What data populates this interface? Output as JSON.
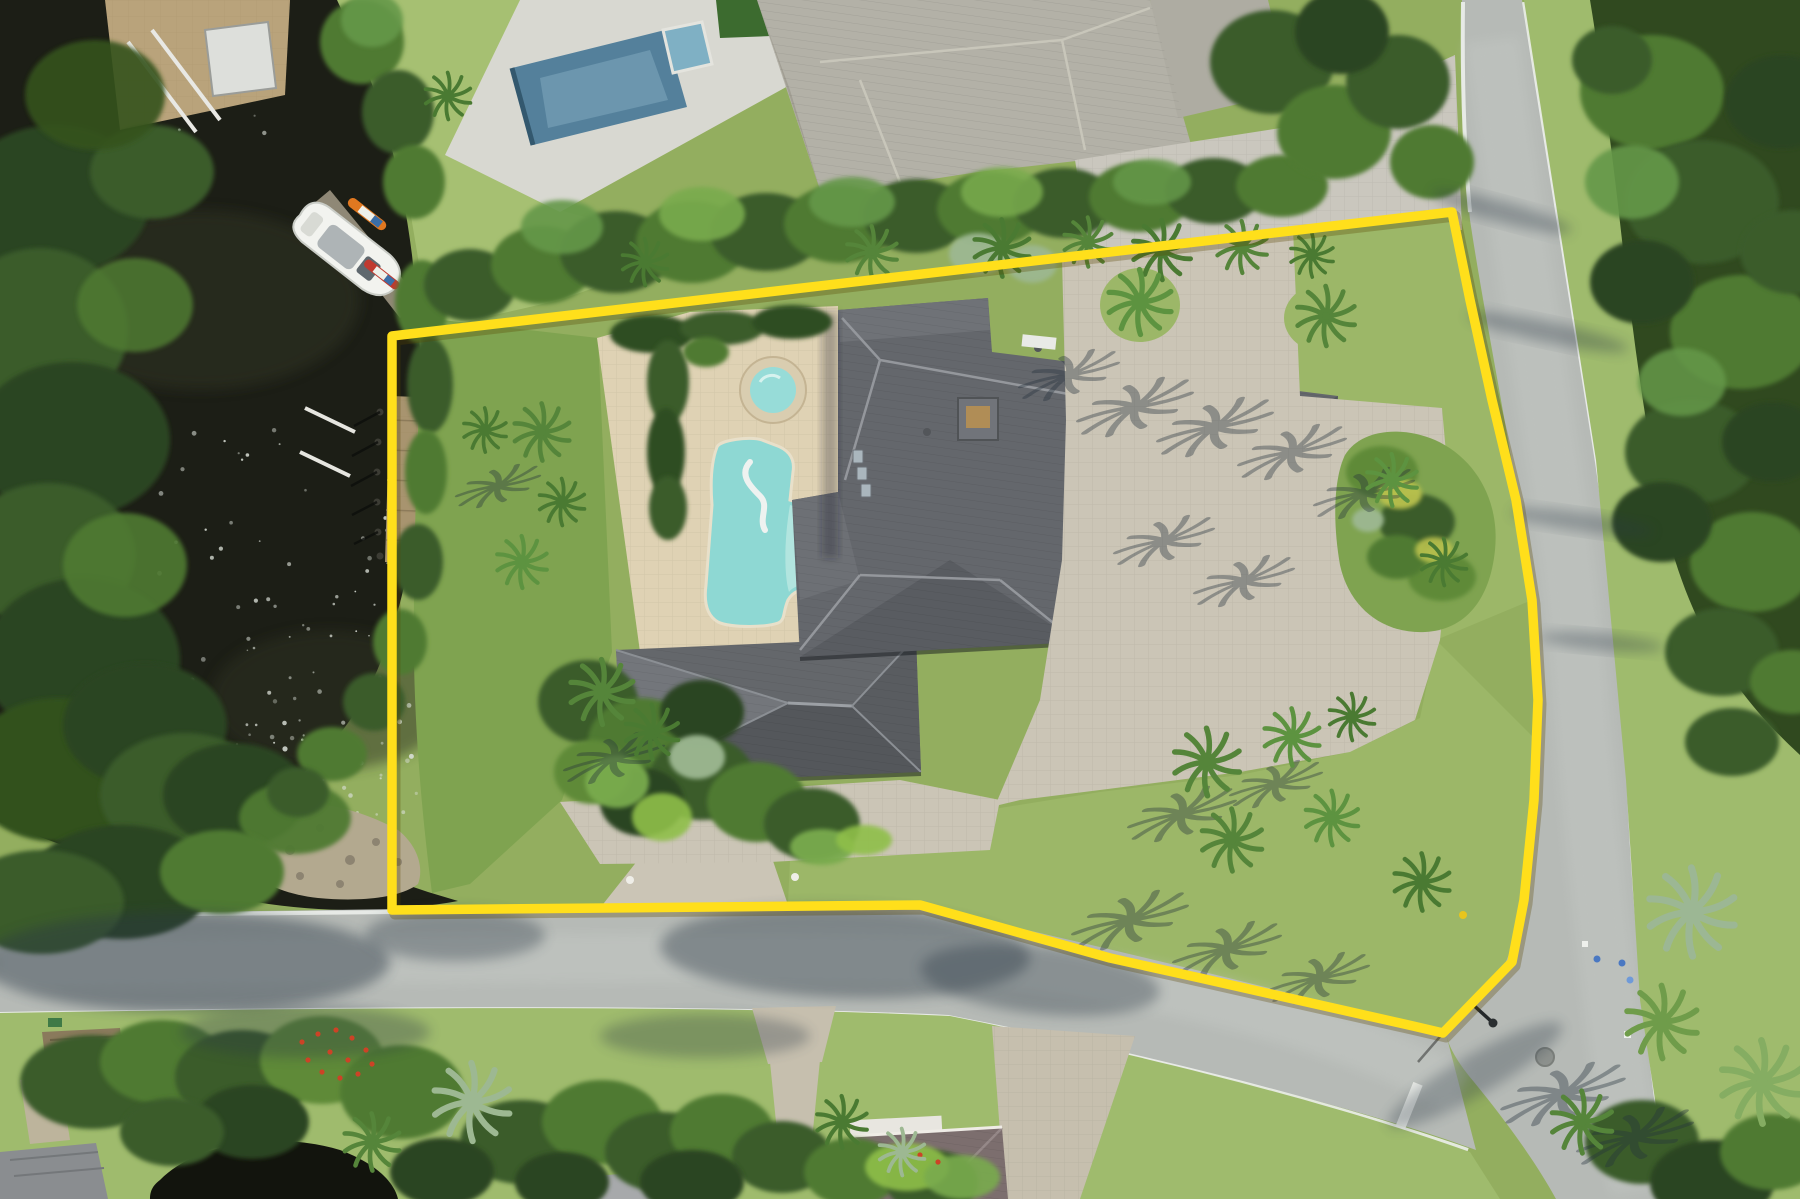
{
  "meta": {
    "title": "Aerial drone photo of waterfront estate with yellow property boundary outline",
    "type": "aerial-photograph",
    "width": 1800,
    "height": 1199
  },
  "scene": {
    "description": "Overhead aerial of a waterfront lot: dark canal with docks and a white boat on the left, large gray hip-roof estate with freeform pool and spa in the center, paver motor court with palms on the right, curving light-gray street along the bottom and right, neighboring homes top and bottom, and a bright yellow surveyed lot outline.",
    "colors": {
      "water": "#1c1e16",
      "lawn_base": "#93ae5f",
      "lawn_neighbor": "#a6c072",
      "lawn_subject": "#7fa350",
      "lawn_front": "#9cb768",
      "lawn_verge": "#9fbb6d",
      "road": "#b6bab6",
      "curb": "#edf0ec",
      "paver_court": "#cbc5b6",
      "paver_neighbor": "#cac7be",
      "pool_deck": "#dfd2b4",
      "pool_water": "#8ed8d3",
      "pool_light": "#b9e7e0",
      "spa_water": "#97dcd8",
      "spa_ring": "#d9cdb0",
      "roof_main": "#64676c",
      "roof_neighbor": "#b3b1a7",
      "roof_bottom": "#7c6e6e",
      "neighbor_pool": "#54809b",
      "wood_dock": "#a8946f",
      "rock": "#b3a98f",
      "boundary": "#ffdf1b"
    },
    "boundary": {
      "label": "property lot outline",
      "points": "392,336 1452,212 1470,300 1492,400 1516,500 1532,600 1538,700 1534,800 1524,900 1512,962 1443,1033 1413,1026 1200,978 1110,958 920,905 392,910",
      "width": 9.5
    },
    "water_path": "M0,0 L337,0 C382,95 402,175 412,255 C421,335 425,420 419,485 C412,570 394,645 360,705 C328,756 288,792 250,806 C298,842 362,870 428,892 L458,901 C398,912 328,914 256,902 C176,888 86,854 0,822 Z",
    "sparkles": {
      "color": "#d9ded6",
      "seed": 7,
      "areas": [
        [
          150,
          430,
          280,
          430,
          70
        ],
        [
          240,
          600,
          180,
          280,
          55
        ],
        [
          120,
          60,
          160,
          80,
          12
        ]
      ]
    },
    "tree_blobs": [
      [
        55,
        200,
        95,
        75,
        "#2c4520",
        1
      ],
      [
        40,
        330,
        88,
        82,
        "#3b5c29",
        1
      ],
      [
        72,
        440,
        98,
        78,
        "#2c4520",
        1
      ],
      [
        48,
        555,
        88,
        72,
        "#3b5c29",
        1
      ],
      [
        82,
        660,
        98,
        82,
        "#2c4520",
        1
      ],
      [
        58,
        770,
        92,
        72,
        "#33511f",
        1
      ],
      [
        145,
        725,
        82,
        62,
        "#2c4520",
        1
      ],
      [
        185,
        795,
        85,
        62,
        "#3b5c29",
        1
      ],
      [
        125,
        565,
        62,
        52,
        "#4f7a33",
        0.9
      ],
      [
        135,
        305,
        58,
        47,
        "#4f7a33",
        0.85
      ],
      [
        152,
        172,
        62,
        47,
        "#3b5c29",
        1
      ],
      [
        95,
        95,
        70,
        55,
        "#35531f",
        0.9
      ],
      [
        235,
        795,
        72,
        52,
        "#2c4520",
        1
      ],
      [
        295,
        818,
        56,
        36,
        "#4f7a33",
        0.95
      ],
      [
        422,
        302,
        27,
        42,
        "#4f7a33",
        1
      ],
      [
        430,
        385,
        23,
        48,
        "#3b5c29",
        1
      ],
      [
        426,
        472,
        21,
        42,
        "#4f7a33",
        1
      ],
      [
        418,
        562,
        25,
        38,
        "#3b5c29",
        1
      ],
      [
        400,
        642,
        27,
        33,
        "#4f7a33",
        1
      ],
      [
        374,
        702,
        31,
        29,
        "#3b5c29",
        1
      ],
      [
        332,
        754,
        35,
        27,
        "#4f7a33",
        1
      ],
      [
        298,
        792,
        31,
        25,
        "#3b5c29",
        1
      ],
      [
        362,
        42,
        42,
        42,
        "#4f7a33",
        1
      ],
      [
        398,
        112,
        36,
        42,
        "#3b5c29",
        1
      ],
      [
        414,
        182,
        31,
        37,
        "#4f7a33",
        1
      ],
      [
        372,
        20,
        31,
        27,
        "#65984a",
        0.9
      ],
      [
        470,
        285,
        46,
        36,
        "#3b5c29",
        1
      ],
      [
        542,
        265,
        51,
        39,
        "#4f7a33",
        1
      ],
      [
        616,
        252,
        56,
        41,
        "#3b5c29",
        1
      ],
      [
        692,
        242,
        56,
        41,
        "#4f7a33",
        1
      ],
      [
        766,
        232,
        56,
        39,
        "#3b5c29",
        1
      ],
      [
        840,
        224,
        56,
        39,
        "#4f7a33",
        1
      ],
      [
        916,
        216,
        53,
        37,
        "#3b5c29",
        1
      ],
      [
        990,
        209,
        53,
        37,
        "#4f7a33",
        1
      ],
      [
        1064,
        203,
        51,
        35,
        "#3b5c29",
        1
      ],
      [
        1140,
        197,
        51,
        35,
        "#4f7a33",
        1
      ],
      [
        1214,
        191,
        49,
        33,
        "#3b5c29",
        1
      ],
      [
        1282,
        186,
        46,
        31,
        "#4f7a33",
        1
      ],
      [
        562,
        227,
        41,
        27,
        "#65984a",
        0.9
      ],
      [
        702,
        214,
        43,
        27,
        "#79ab4e",
        0.9
      ],
      [
        852,
        202,
        43,
        25,
        "#65984a",
        0.9
      ],
      [
        1002,
        192,
        41,
        25,
        "#79ab4e",
        0.85
      ],
      [
        1152,
        182,
        39,
        23,
        "#65984a",
        0.85
      ],
      [
        978,
        254,
        29,
        21,
        "#9db892",
        0.95
      ],
      [
        1032,
        264,
        25,
        19,
        "#9db892",
        0.9
      ],
      [
        1272,
        62,
        62,
        52,
        "#3b5c29",
        1
      ],
      [
        1334,
        132,
        57,
        47,
        "#4f7a33",
        1
      ],
      [
        1398,
        82,
        52,
        47,
        "#3b5c29",
        1
      ],
      [
        1342,
        32,
        47,
        42,
        "#2c4520",
        1
      ],
      [
        1432,
        162,
        42,
        37,
        "#4f7a33",
        1
      ],
      [
        652,
        334,
        42,
        19,
        "#2f4d24",
        1
      ],
      [
        722,
        328,
        42,
        17,
        "#3b5c29",
        1
      ],
      [
        792,
        322,
        40,
        17,
        "#2f4d24",
        1
      ],
      [
        668,
        382,
        21,
        42,
        "#3b5c29",
        1
      ],
      [
        666,
        452,
        19,
        44,
        "#2f4d24",
        1
      ],
      [
        668,
        508,
        19,
        32,
        "#3b5c29",
        1
      ],
      [
        706,
        352,
        23,
        15,
        "#4f7a33",
        1
      ],
      [
        588,
        702,
        50,
        42,
        "#3b5c29",
        1
      ],
      [
        642,
        742,
        54,
        44,
        "#4f7a33",
        1
      ],
      [
        702,
        778,
        52,
        42,
        "#3b5c29",
        1
      ],
      [
        757,
        802,
        50,
        40,
        "#4f7a33",
        1
      ],
      [
        812,
        824,
        48,
        36,
        "#3b5c29",
        1
      ],
      [
        642,
        802,
        42,
        34,
        "#2c4520",
        1
      ],
      [
        592,
        772,
        38,
        32,
        "#5e8a38",
        1
      ],
      [
        702,
        712,
        42,
        32,
        "#2c4520",
        1
      ],
      [
        617,
        782,
        32,
        26,
        "#79ab4e",
        0.95
      ],
      [
        662,
        817,
        30,
        24,
        "#8fbf4a",
        0.9
      ],
      [
        697,
        757,
        28,
        22,
        "#9db892",
        0.95
      ],
      [
        822,
        847,
        32,
        18,
        "#79ab4e",
        0.95
      ],
      [
        864,
        840,
        28,
        15,
        "#8fbf4a",
        0.9
      ],
      [
        1382,
        472,
        36,
        26,
        "#5e8a38",
        1
      ],
      [
        1417,
        522,
        38,
        28,
        "#3b5c29",
        1
      ],
      [
        1442,
        577,
        34,
        24,
        "#5e8a38",
        1
      ],
      [
        1397,
        557,
        30,
        22,
        "#4f7a33",
        1
      ],
      [
        1400,
        494,
        22,
        15,
        "#b9c14e",
        0.95
      ],
      [
        1434,
        550,
        19,
        13,
        "#b9c14e",
        0.9
      ],
      [
        1368,
        520,
        16,
        12,
        "#9db892",
        0.95
      ],
      [
        92,
        1082,
        72,
        47,
        "#3b5c29",
        1
      ],
      [
        162,
        1062,
        62,
        42,
        "#4f7a33",
        1
      ],
      [
        242,
        1077,
        67,
        47,
        "#3b5c29",
        1
      ],
      [
        322,
        1060,
        62,
        44,
        "#5e8a38",
        1
      ],
      [
        402,
        1092,
        62,
        47,
        "#4f7a33",
        1
      ],
      [
        522,
        1142,
        62,
        42,
        "#3b5c29",
        1
      ],
      [
        602,
        1122,
        60,
        42,
        "#4f7a33",
        1
      ],
      [
        662,
        1152,
        57,
        40,
        "#3b5c29",
        1
      ],
      [
        722,
        1132,
        52,
        38,
        "#4f7a33",
        1
      ],
      [
        782,
        1157,
        50,
        36,
        "#3b5c29",
        1
      ],
      [
        852,
        1172,
        48,
        34,
        "#4f7a33",
        1
      ],
      [
        932,
        1182,
        46,
        32,
        "#3b5c29",
        1
      ],
      [
        692,
        1182,
        52,
        32,
        "#2c4520",
        1
      ],
      [
        562,
        1182,
        47,
        30,
        "#2c4520",
        1
      ],
      [
        442,
        1172,
        52,
        34,
        "#2c4520",
        1
      ],
      [
        252,
        1122,
        57,
        37,
        "#2c4520",
        1
      ],
      [
        172,
        1132,
        52,
        34,
        "#3b5c29",
        1
      ],
      [
        907,
        1167,
        42,
        24,
        "#8fbf4a",
        0.9
      ],
      [
        962,
        1177,
        38,
        22,
        "#79ab4e",
        0.9
      ],
      [
        1652,
        92,
        72,
        57,
        "#4f7a33",
        1
      ],
      [
        1702,
        202,
        77,
        62,
        "#3b5c29",
        1
      ],
      [
        1742,
        332,
        72,
        57,
        "#4f7a33",
        1
      ],
      [
        1692,
        452,
        67,
        52,
        "#3b5c29",
        1
      ],
      [
        1752,
        562,
        62,
        50,
        "#4f7a33",
        1
      ],
      [
        1722,
        652,
        57,
        44,
        "#3b5c29",
        1
      ],
      [
        1642,
        282,
        52,
        42,
        "#2c4520",
        1
      ],
      [
        1662,
        522,
        50,
        40,
        "#2c4520",
        1
      ],
      [
        1782,
        102,
        57,
        47,
        "#2c4520",
        1
      ],
      [
        1792,
        252,
        52,
        42,
        "#3b5c29",
        1
      ],
      [
        1772,
        442,
        50,
        40,
        "#2c4520",
        1
      ],
      [
        1632,
        182,
        47,
        37,
        "#65984a",
        0.9
      ],
      [
        1682,
        382,
        44,
        34,
        "#65984a",
        0.85
      ],
      [
        1732,
        742,
        47,
        34,
        "#3b5c29",
        1
      ],
      [
        1792,
        682,
        42,
        32,
        "#4f7a33",
        1
      ],
      [
        1612,
        60,
        40,
        34,
        "#3b5c29",
        1
      ],
      [
        122,
        882,
        92,
        57,
        "#2c4520",
        1
      ],
      [
        42,
        902,
        82,
        52,
        "#3b5c29",
        1
      ],
      [
        222,
        872,
        62,
        42,
        "#4f7a33",
        1
      ],
      [
        1642,
        1142,
        57,
        42,
        "#3b5c29",
        1
      ],
      [
        1712,
        1182,
        62,
        42,
        "#2c4520",
        1
      ],
      [
        1772,
        1152,
        52,
        38,
        "#4f7a33",
        1
      ]
    ],
    "palms": [
      [
        645,
        262,
        0.9,
        "#4a7a32"
      ],
      [
        872,
        252,
        1.0,
        "#55853a"
      ],
      [
        1002,
        248,
        1.1,
        "#4a7a32"
      ],
      [
        1088,
        242,
        0.95,
        "#55853a"
      ],
      [
        1162,
        250,
        1.15,
        "#4a7a32"
      ],
      [
        1242,
        247,
        1.0,
        "#55853a"
      ],
      [
        1312,
        255,
        0.85,
        "#4a7a32"
      ],
      [
        1140,
        302,
        1.25,
        "#5d9340"
      ],
      [
        1326,
        316,
        1.15,
        "#55853a"
      ],
      [
        1392,
        480,
        1.0,
        "#5d9340"
      ],
      [
        1444,
        562,
        0.9,
        "#4a7a32"
      ],
      [
        1207,
        762,
        1.3,
        "#55853a"
      ],
      [
        1292,
        737,
        1.1,
        "#5d9340"
      ],
      [
        1352,
        717,
        0.9,
        "#4a7a32"
      ],
      [
        1232,
        840,
        1.2,
        "#55853a"
      ],
      [
        1332,
        818,
        1.05,
        "#5d9340"
      ],
      [
        1422,
        882,
        1.1,
        "#4a7a32"
      ],
      [
        542,
        432,
        1.1,
        "#55853a"
      ],
      [
        562,
        502,
        0.9,
        "#4a7a32"
      ],
      [
        522,
        562,
        1.0,
        "#5d9340"
      ],
      [
        485,
        430,
        0.85,
        "#4a7a32"
      ],
      [
        602,
        692,
        1.25,
        "#55853a"
      ],
      [
        652,
        732,
        1.05,
        "#4a7a32"
      ],
      [
        472,
        1102,
        1.5,
        "#9db892"
      ],
      [
        372,
        1142,
        1.1,
        "#55853a"
      ],
      [
        842,
        1122,
        1.0,
        "#4a7a32"
      ],
      [
        902,
        1152,
        0.9,
        "#9db892"
      ],
      [
        1692,
        912,
        1.7,
        "#9cb794"
      ],
      [
        1662,
        1022,
        1.4,
        "#6f9c4a"
      ],
      [
        1762,
        1082,
        1.6,
        "#85ad62"
      ],
      [
        1582,
        1122,
        1.2,
        "#55853a"
      ],
      [
        448,
        96,
        0.9,
        "#4a7a32"
      ]
    ],
    "palm_shadows": [
      [
        1095,
        362,
        1.3
      ],
      [
        1165,
        392,
        1.5
      ],
      [
        1245,
        412,
        1.5
      ],
      [
        1320,
        438,
        1.4
      ],
      [
        1390,
        480,
        1.3
      ],
      [
        1190,
        528,
        1.3
      ],
      [
        1270,
        568,
        1.3
      ],
      [
        1160,
        905,
        1.5
      ],
      [
        1255,
        935,
        1.4
      ],
      [
        1345,
        965,
        1.3
      ],
      [
        1595,
        1078,
        1.6
      ],
      [
        1665,
        1122,
        1.5
      ],
      [
        520,
        475,
        1.1
      ],
      [
        640,
        745,
        1.3
      ],
      [
        1210,
        800,
        1.4
      ],
      [
        1300,
        772,
        1.2
      ]
    ],
    "soft_shadows": [
      [
        185,
        962,
        205,
        50,
        0,
        0.45
      ],
      [
        845,
        952,
        185,
        46,
        2,
        0.4
      ],
      [
        1040,
        980,
        120,
        34,
        6,
        0.35
      ],
      [
        305,
        1032,
        125,
        26,
        0,
        0.32
      ],
      [
        705,
        1036,
        105,
        22,
        0,
        0.3
      ],
      [
        1502,
        212,
        72,
        11,
        15,
        0.33
      ],
      [
        1548,
        332,
        82,
        11,
        12,
        0.33
      ],
      [
        1582,
        522,
        72,
        10,
        8,
        0.3
      ],
      [
        1602,
        642,
        62,
        9,
        5,
        0.3
      ],
      [
        455,
        935,
        90,
        26,
        0,
        0.35
      ],
      [
        1475,
        1075,
        100,
        20,
        -30,
        0.3
      ]
    ],
    "flower_dots": {
      "color": "#cc4326",
      "points": [
        [
          302,
          1042
        ],
        [
          318,
          1034
        ],
        [
          336,
          1030
        ],
        [
          352,
          1038
        ],
        [
          366,
          1050
        ],
        [
          372,
          1064
        ],
        [
          358,
          1074
        ],
        [
          340,
          1078
        ],
        [
          322,
          1072
        ],
        [
          308,
          1060
        ],
        [
          330,
          1052
        ],
        [
          348,
          1060
        ],
        [
          920,
          1155
        ],
        [
          938,
          1162
        ]
      ]
    }
  }
}
